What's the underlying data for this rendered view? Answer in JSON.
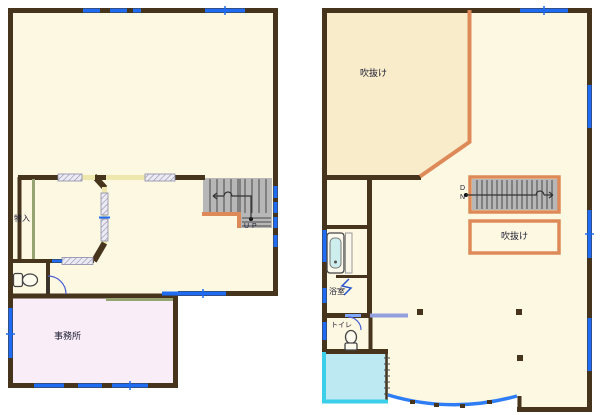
{
  "plans": {
    "floor1": {
      "labels": {
        "storage": "物入",
        "office": "事務所",
        "stairs": "UP"
      }
    },
    "floor2": {
      "labels": {
        "atrium_large": "吹抜け",
        "atrium_void": "吹抜け",
        "bath": "浴室",
        "toilet": "トイレ",
        "stairs": "D N"
      }
    }
  },
  "colors": {
    "wall": "#46341d",
    "floor": "#fdf8e2",
    "atrium": "#f8ecca",
    "office": "#f9eef8",
    "stairs": "#b7b7b7",
    "stairline": "#4a4a4a",
    "orange": "#dd8a58",
    "olive": "#96a474",
    "win": "#1f6bf2",
    "winlight": "#7fa8ff",
    "slider": "#93a0dd",
    "curve": "#2f7df5",
    "terraceline": "#3bcfe9",
    "terracefill": "#bce9f2",
    "fixture": "#fdfbee",
    "dooryellow": "#efe8ae",
    "label": "#1b1b30"
  }
}
